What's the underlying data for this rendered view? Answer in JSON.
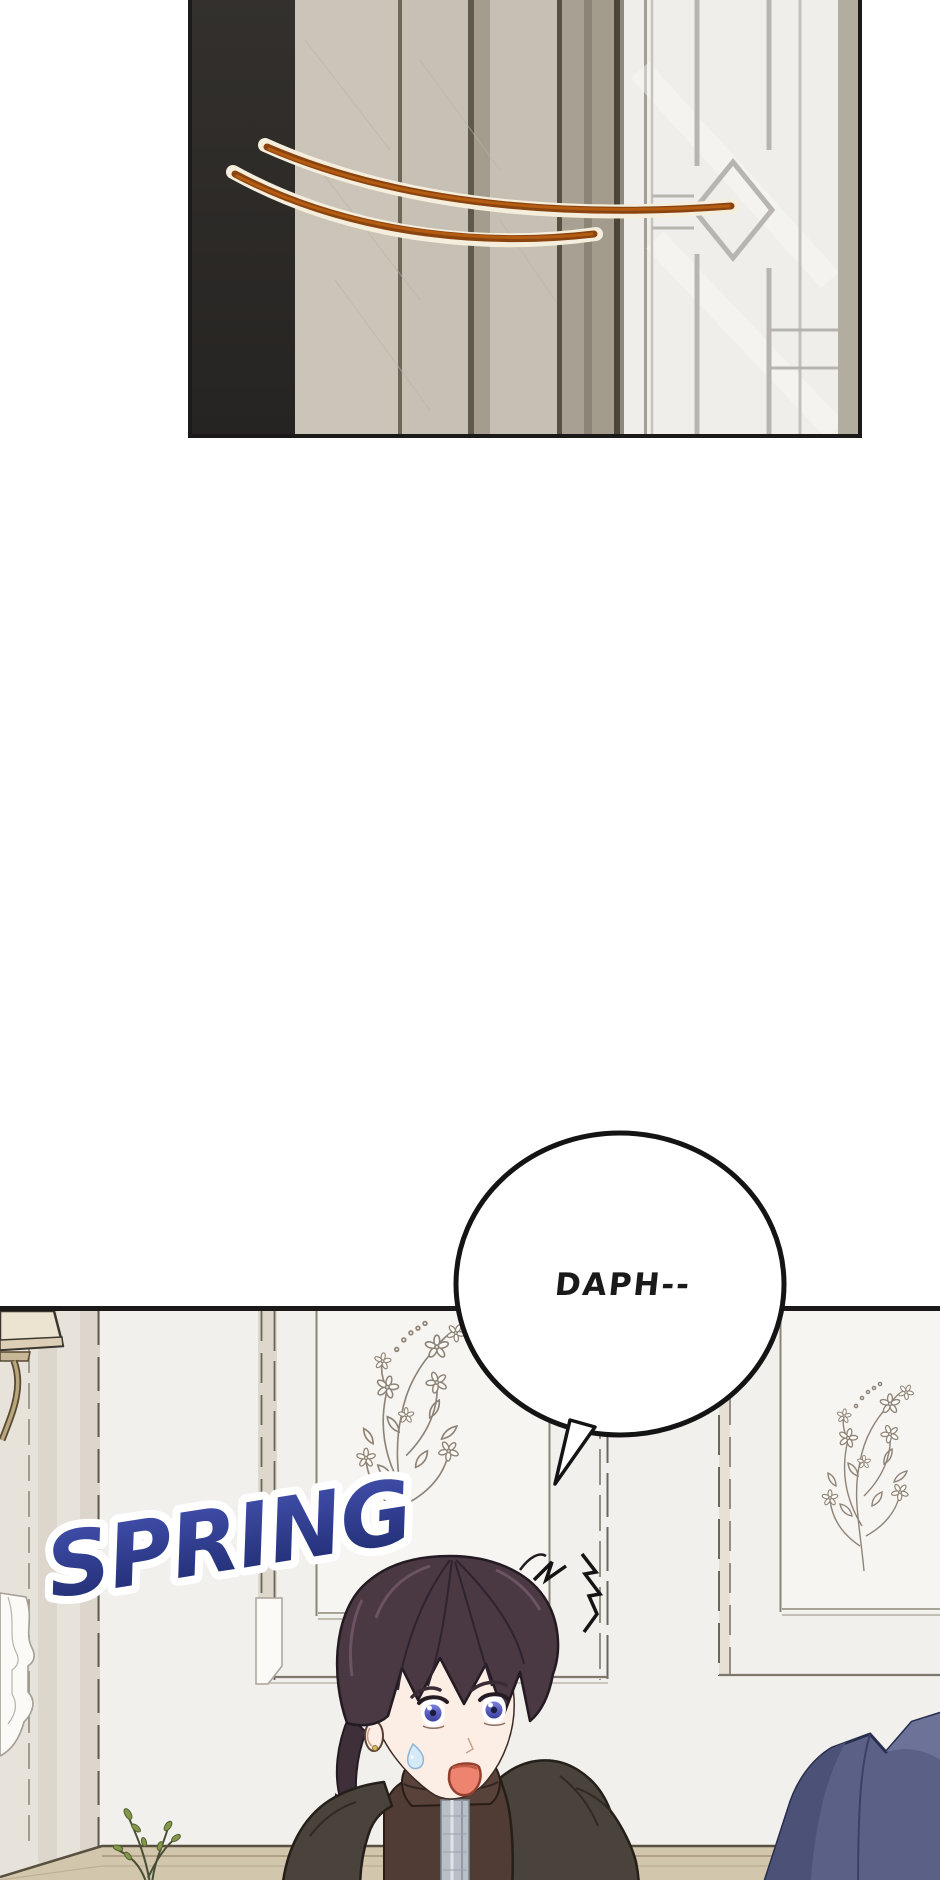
{
  "page": {
    "kind": "webtoon-comic-page",
    "background": "#ffffff"
  },
  "speech_bubble": {
    "text": "DAPH--",
    "fill": "#ffffff",
    "outline_color": "#141414",
    "text_color": "#1a1a1a"
  },
  "sfx": {
    "text": "SPRING",
    "fill_top": "#4452b0",
    "fill_bottom": "#1e2a6e",
    "outline_color": "#ffffff",
    "rotation_deg": -9
  },
  "palette": {
    "panel_border": "#1c1a18",
    "dark_wall_strip": "#2d2a27",
    "wall_beige": "#cbc5b9",
    "door_white": "#f0eeea",
    "lattice_gray": "#b8b5b0",
    "whip_line_brown": "#9a4e13",
    "whip_line_cream": "#f6eedd",
    "scene_wall": "#f2f0ec",
    "scene_wall_shadow": "#e7e2da",
    "wainscot_recess": "#f7f5f1",
    "floral_sketch": "#8e8376",
    "lamp_shade": "#ece3d1",
    "baseboard": "#d2c6ad",
    "plant_green": "#7f9447",
    "hair_purple": "#4a3843",
    "skin": "#fdeee5",
    "eye_iris": "#5a62c8",
    "mouth": "#ee8370",
    "jacket_brown": "#4f3b33",
    "zipper_gray": "#b9bfc7",
    "cloak_gray": "#49433b",
    "blue_figure": "#5b6186"
  },
  "scene": {
    "top_panel": "interior wall with dark pillar and glass-paned door crossed by two curved whip lines",
    "objects": [
      "wall-lamp",
      "floral-wainscot-panel-center",
      "floral-wainscot-panel-right",
      "door-molding-left",
      "baseboard",
      "plant-sprig",
      "startled-ponytail-character",
      "surprise-flash-mark",
      "blue-cloaked-shoulder"
    ]
  }
}
